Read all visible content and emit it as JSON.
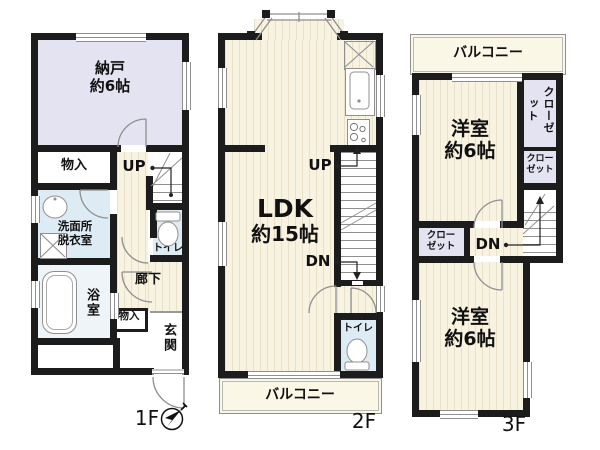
{
  "colors": {
    "wall": "#1c1c1c",
    "flooring": "#f8f2e0",
    "flooring_stripe": "#e8e1ca",
    "storage_room": "#e4e3f1",
    "wet_area": "#dcebf4",
    "bath": "#eef4f7",
    "balcony": "#fbf7e6",
    "line": "#8f8f8f"
  },
  "floors": {
    "f1": {
      "label": "1F",
      "nando": "納戸\n約6帖",
      "monoire_upper": "物入",
      "up": "UP",
      "senmen": "洗面所\n脱衣室",
      "toilet": "トイレ",
      "bath": "浴室",
      "rouka": "廊下",
      "monoire_lower": "物入",
      "genkan": "玄関"
    },
    "f2": {
      "label": "2F",
      "ldk_line1": "LDK",
      "ldk_line2": "約15帖",
      "up": "UP",
      "dn": "DN",
      "toilet": "トイレ",
      "balcony": "バルコニー"
    },
    "f3": {
      "label": "3F",
      "balcony": "バルコニー",
      "bedroom1": "洋室\n約6帖",
      "closet_right_upper": "クローゼット",
      "closet_right_lower": "クロー\nゼット",
      "closet_left": "クロー\nゼット",
      "dn": "DN",
      "bedroom2": "洋室\n約6帖"
    }
  }
}
